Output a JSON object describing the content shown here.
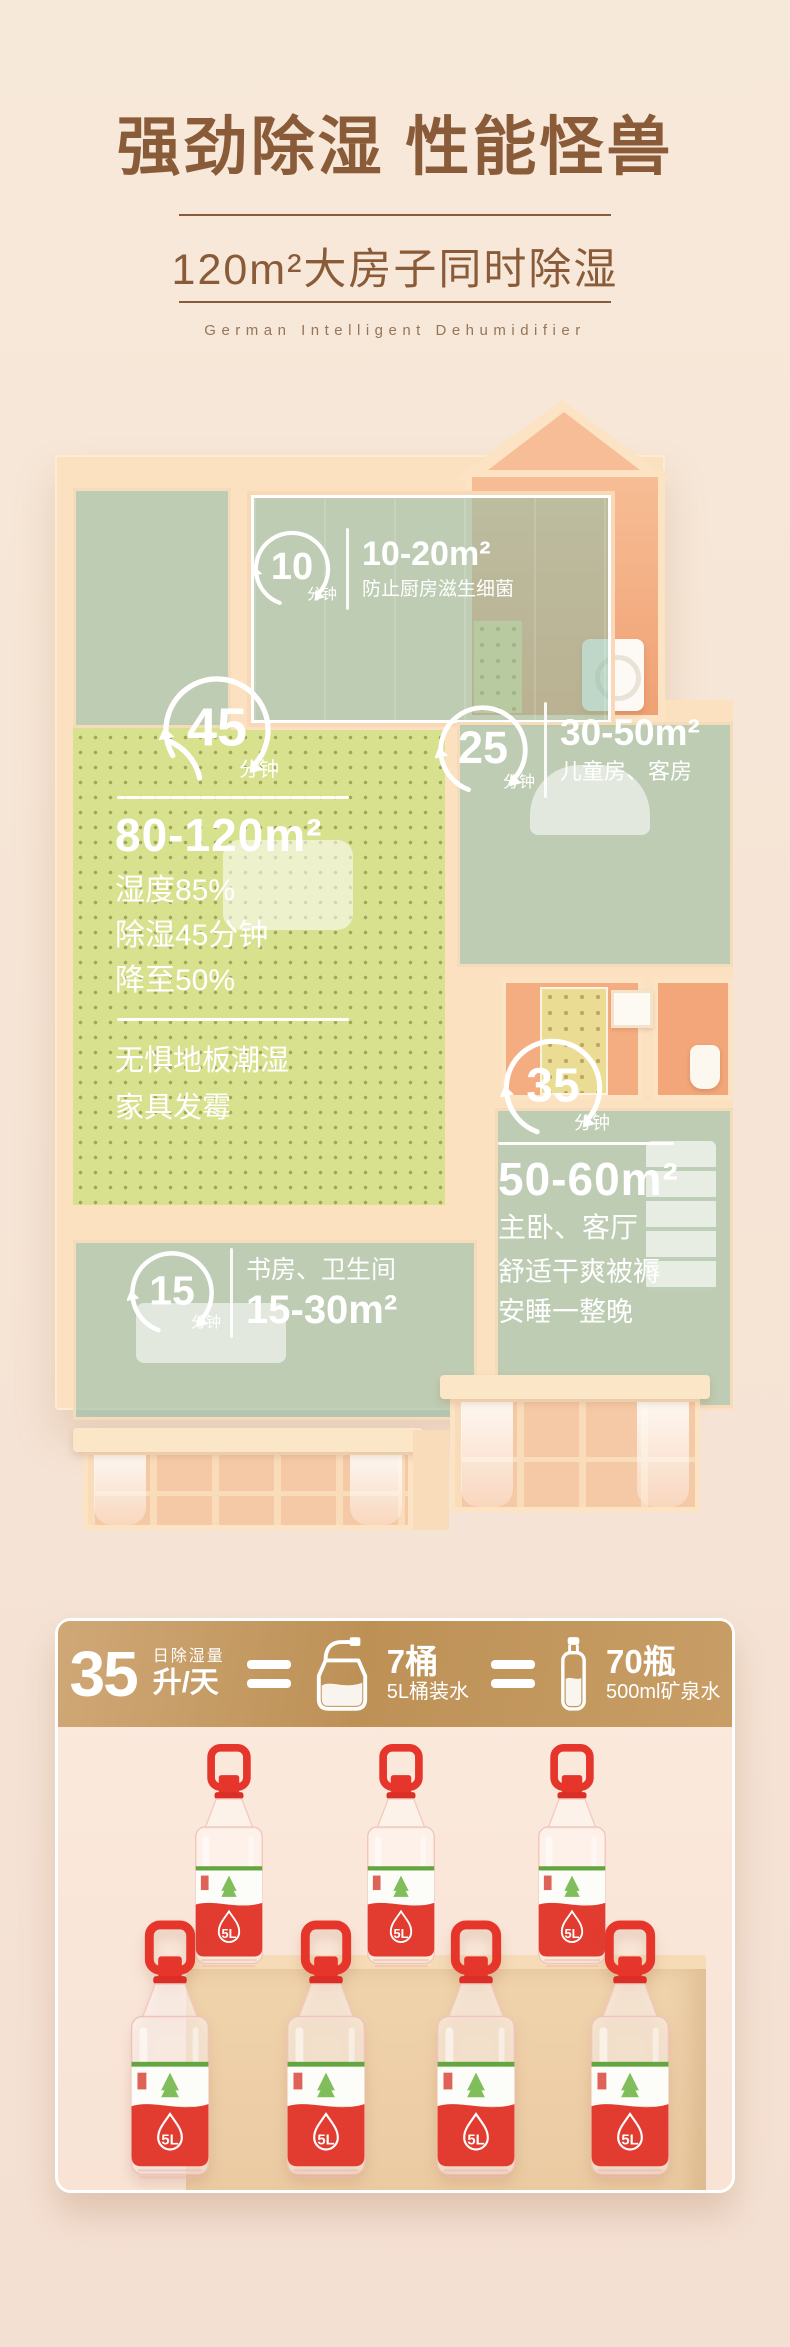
{
  "header": {
    "title": "强劲除湿 性能怪兽",
    "subtitle": "120m²大房子同时除湿",
    "tagline": "German Intelligent Dehumidifier"
  },
  "floorplan": {
    "kitchen": {
      "minutes": "10",
      "unit": "分钟",
      "area": "10-20m²",
      "desc": "防止厨房滋生细菌"
    },
    "living": {
      "minutes": "45",
      "unit": "分钟",
      "area": "80-120m²",
      "stat1": "湿度85%",
      "stat2": "除湿45分钟",
      "stat3": "降至50%",
      "note1": "无惧地板潮湿",
      "note2": "家具发霉"
    },
    "kids": {
      "minutes": "25",
      "unit": "分钟",
      "area": "30-50m²",
      "desc": "儿童房、客房"
    },
    "master": {
      "minutes": "35",
      "unit": "分钟",
      "area": "50-60m²",
      "desc": "主卧、客厅",
      "note1": "舒适干爽被褥",
      "note2": "安睡一整晚"
    },
    "study": {
      "minutes": "15",
      "unit": "分钟",
      "rooms": "书房、卫生间",
      "area": "15-30m²"
    }
  },
  "capacity": {
    "amount": "35",
    "label_top": "日除湿量",
    "label_bottom": "升/天",
    "jug_count": "7桶",
    "jug_desc": "5L桶装水",
    "bottle_count": "70瓶",
    "bottle_desc": "500ml矿泉水"
  },
  "bottles": {
    "label": "5L",
    "count": 7
  },
  "colors": {
    "title_brown": "#8a5b38",
    "gold_start": "#d0a877",
    "gold_end": "#c89e66",
    "wall_peach": "#fbe1c0",
    "floor_green": "#d8e18e",
    "glass_teal": "#92bda8",
    "bottle_red": "#e6352b",
    "band_green": "#63a53f",
    "page_bg": "#f6e5d6"
  },
  "icons": {
    "timer": "circular-refresh-arrows",
    "equals": "double-bar-equals",
    "jug": "5l-water-jug-outline",
    "bottle": "mineral-water-bottle-outline"
  }
}
